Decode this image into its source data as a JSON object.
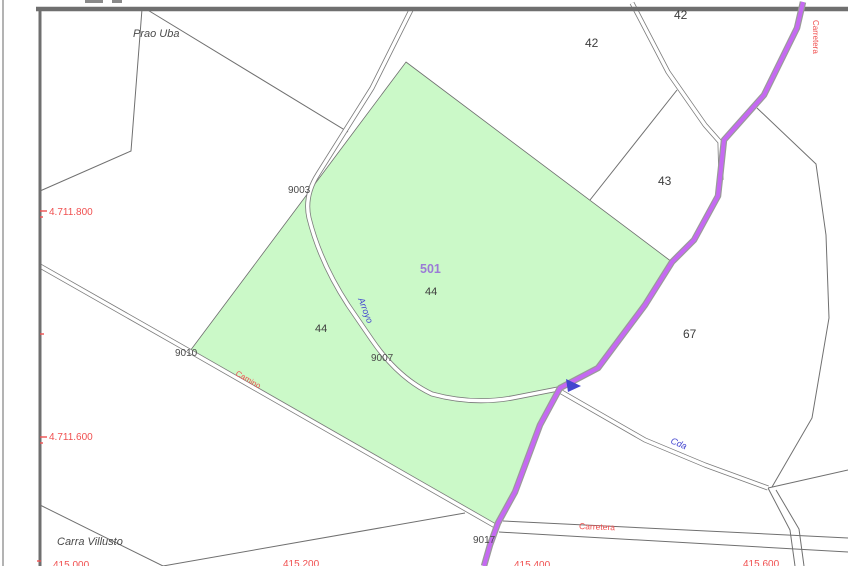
{
  "map": {
    "type": "cadastral-parcel-map",
    "colors": {
      "parcel_highlight_green": "#cbf9c8",
      "road_purple": "#c569f2",
      "label_red": "#f05050",
      "label_blue": "#4345cf",
      "highlight_id_purple": "#9b7bd6",
      "line_gray": "#707070",
      "text_dark": "#3d3d3d",
      "border_gray": "#6f6f6f"
    },
    "highlighted_parcel": {
      "id": "501",
      "number": "44"
    },
    "labels": {
      "prao_uba": "Prao Uba",
      "carra_villusto": "Carra Villusto",
      "y_4711800": "4.711.800",
      "y_4711600": "4.711.600",
      "x_415000": "415.000",
      "x_415200": "415.200",
      "x_415400": "415.400",
      "x_415600": "415.600",
      "parcel_42a": "42",
      "parcel_42b": "42",
      "parcel_43": "43",
      "parcel_67": "67",
      "parcel_44_west": "44",
      "parcel_44_central": "44",
      "highlight_id": "501",
      "node_9003": "9003",
      "node_9007": "9007",
      "node_9010": "9010",
      "node_9017": "9017",
      "road_arroyo": "Arroyo",
      "road_camino": "Camino",
      "road_cda": "Cda",
      "road_carretera": "Carretera",
      "road_carretera_vertical": "Carretera"
    },
    "icons": {
      "flow_arrow": "blue-direction-arrow"
    }
  }
}
